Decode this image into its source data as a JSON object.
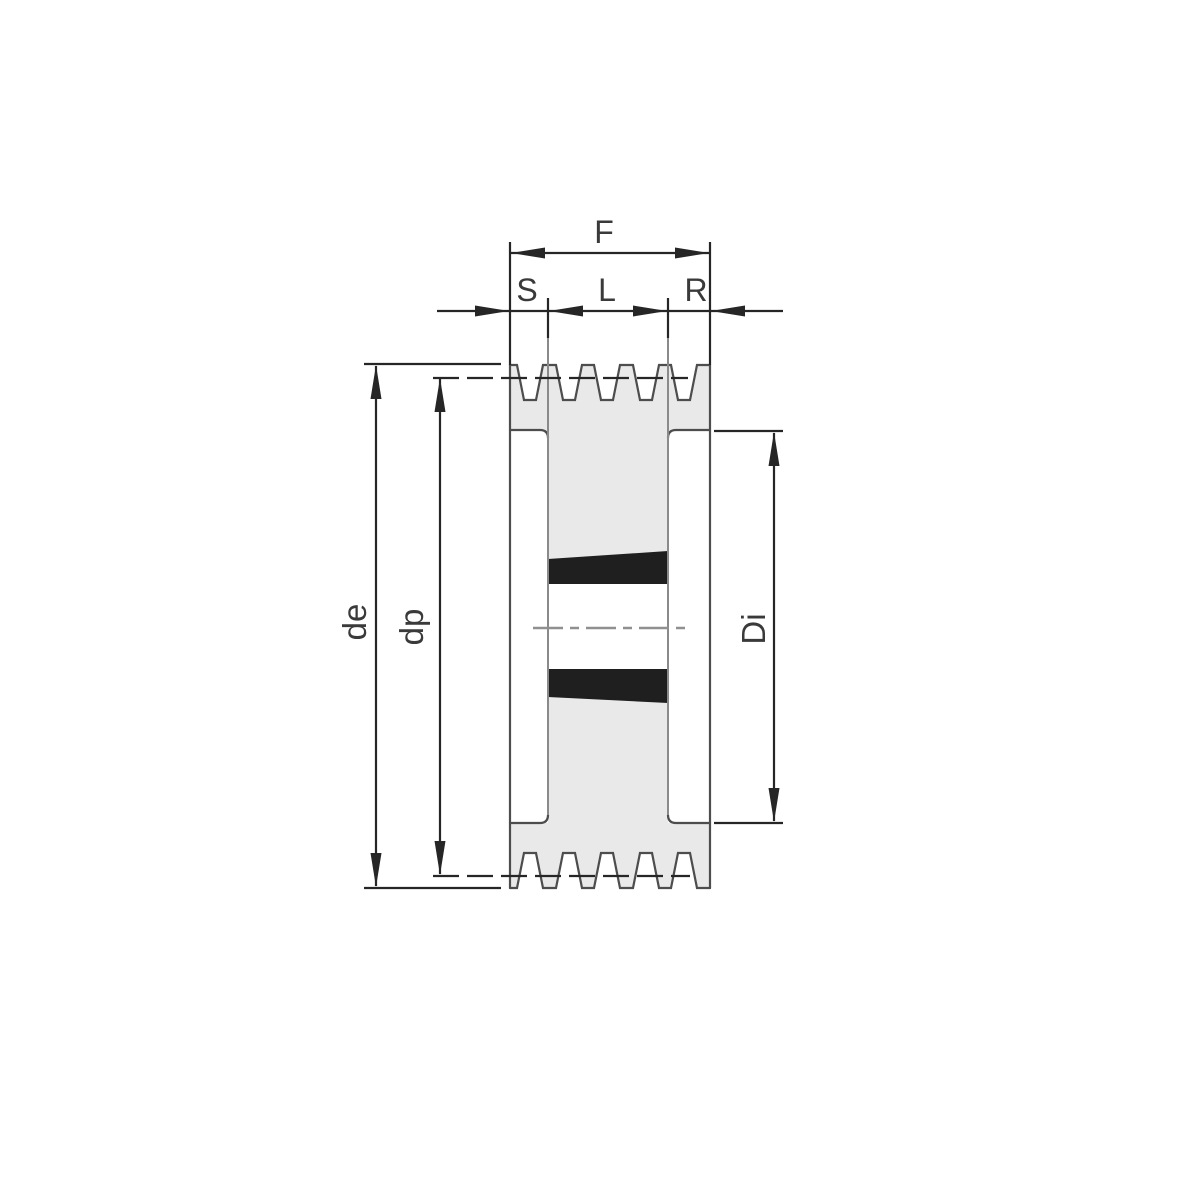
{
  "diagram": {
    "type": "taper-bush v-belt pulley cross-section",
    "labels": {
      "face_width": "F",
      "offset_s": "S",
      "bush_length": "L",
      "offset_r": "R",
      "outside_diameter": "de",
      "pitch_diameter": "dp",
      "rim_inside_diameter": "Di"
    },
    "colors": {
      "background": "#ffffff",
      "body_fill": "#e9e9e9",
      "outline": "#4d4d4d",
      "dimension": "#262626",
      "label_text": "#3a3a3a",
      "bush_fill": "#1f1f1f",
      "hub_line": "#8a8a8a",
      "centerline": "#909090"
    }
  }
}
